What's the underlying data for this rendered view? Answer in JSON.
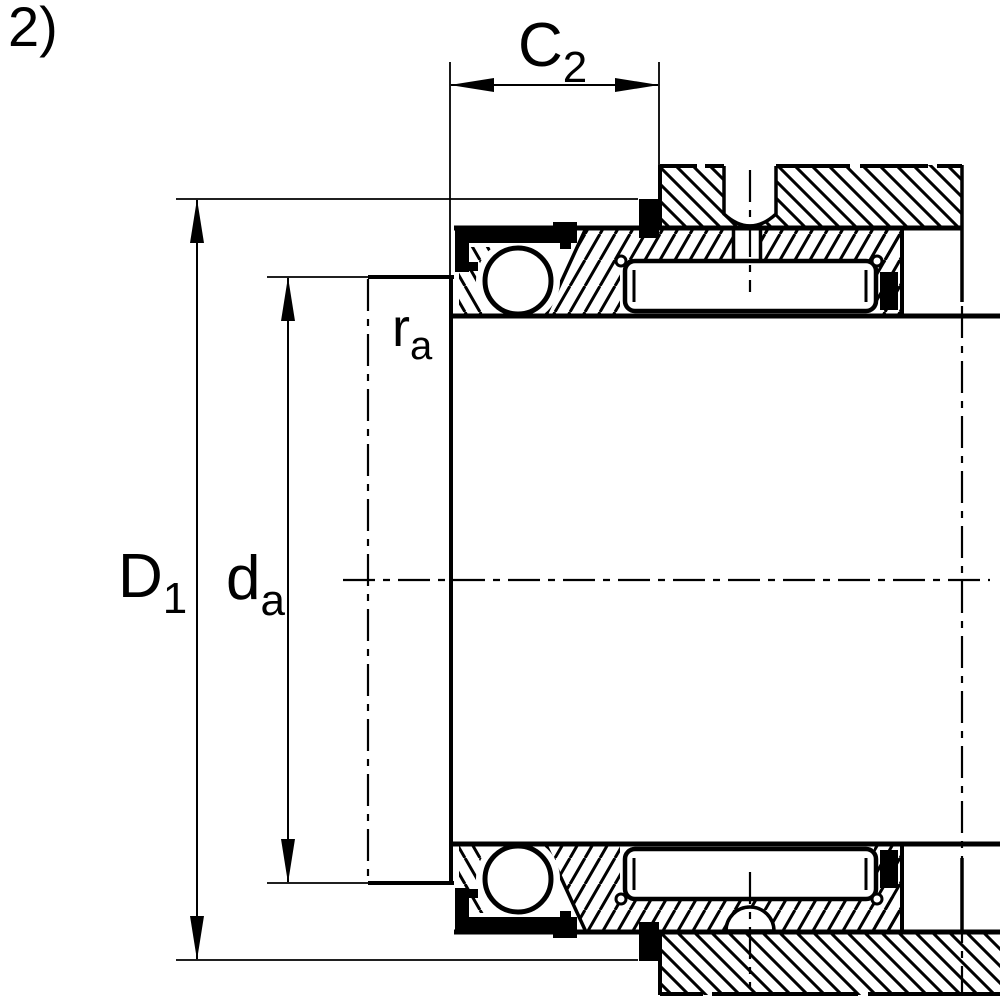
{
  "figure": {
    "marker": "2)",
    "description": "Bearing mounting cross-section drawing"
  },
  "dimensions": {
    "c2": {
      "base": "C",
      "sub": "2"
    },
    "d1": {
      "base": "D",
      "sub": "1"
    },
    "da": {
      "base": "d",
      "sub": "a"
    },
    "ra": {
      "base": "r",
      "sub": "a"
    }
  },
  "colors": {
    "line": "#000000",
    "background": "#ffffff"
  }
}
